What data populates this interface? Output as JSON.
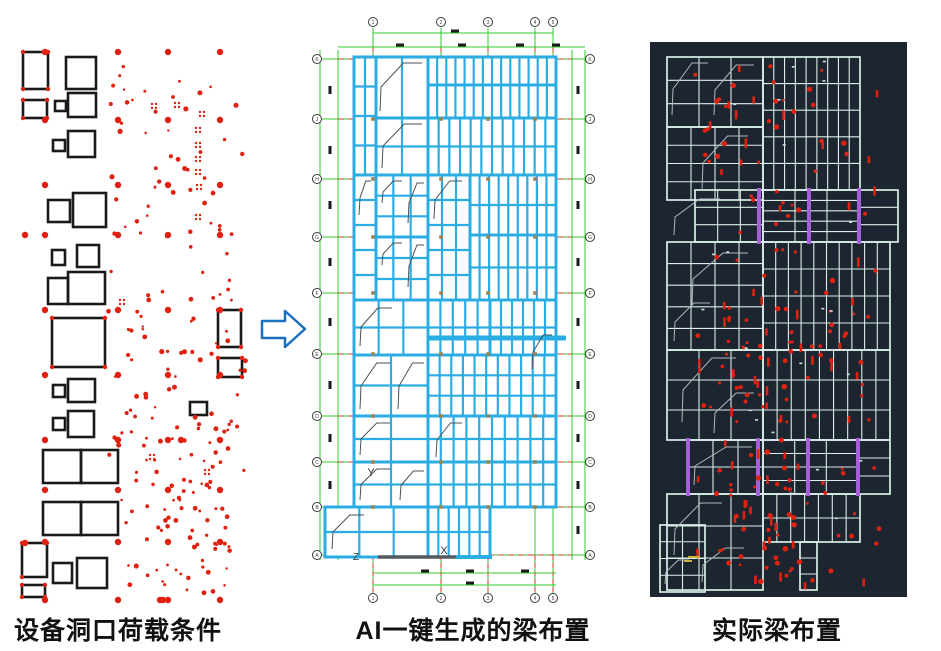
{
  "canvas": {
    "w": 941,
    "h": 651,
    "bg": "#ffffff"
  },
  "captions": {
    "left": "设备洞口荷载条件",
    "middle": "AI一键生成的梁布置",
    "right": "实际梁布置"
  },
  "colors": {
    "black": "#1a1a1a",
    "red": "#dd2212",
    "red_big": "#e02010",
    "cyan": "#2bade4",
    "green": "#2ecc2e",
    "grid_red": "#d03a2a",
    "olive": "#9b8450",
    "stair_gray": "#4a5156",
    "ucs_dark": "#2b3a42",
    "dark_bg": "#1d2630",
    "beam_light": "#d9efe8",
    "stair_light": "#aeb8bc",
    "purple": "#a55fd9",
    "yellow": "#c9b23e",
    "speck": "#cfe0e0",
    "arrow_blue": "#1d6fc0",
    "bubble": "#3a3a3a"
  },
  "arrow": {
    "points": "262,321 285,321 285,311 305,329 285,347 285,338 262,338"
  },
  "left_panel": {
    "rects": [
      [
        23,
        52,
        25,
        37
      ],
      [
        66,
        57,
        30,
        32
      ],
      [
        55,
        101,
        11,
        10
      ],
      [
        23,
        100,
        24,
        18
      ],
      [
        68,
        93,
        28,
        24
      ],
      [
        53,
        140,
        12,
        11
      ],
      [
        68,
        131,
        27,
        26
      ],
      [
        48,
        200,
        22,
        22
      ],
      [
        73,
        193,
        33,
        34
      ],
      [
        52,
        250,
        13,
        15
      ],
      [
        77,
        245,
        22,
        22
      ],
      [
        48,
        278,
        20,
        26
      ],
      [
        68,
        272,
        37,
        32
      ],
      [
        52,
        318,
        53,
        49
      ],
      [
        218,
        310,
        23,
        37
      ],
      [
        218,
        358,
        24,
        19
      ],
      [
        53,
        385,
        12,
        12
      ],
      [
        68,
        379,
        27,
        23
      ],
      [
        53,
        418,
        12,
        12
      ],
      [
        68,
        411,
        26,
        26
      ],
      [
        190,
        402,
        17,
        13
      ],
      [
        43,
        450,
        38,
        33
      ],
      [
        81,
        450,
        37,
        33
      ],
      [
        43,
        502,
        38,
        33
      ],
      [
        81,
        502,
        37,
        33
      ],
      [
        22,
        543,
        25,
        34
      ],
      [
        53,
        563,
        19,
        20
      ],
      [
        77,
        558,
        30,
        30
      ],
      [
        22,
        585,
        23,
        12
      ]
    ],
    "big_dot_cols": [
      45,
      118,
      168,
      220
    ],
    "big_dot_rows": [
      52,
      120,
      185,
      235,
      310,
      375,
      440,
      490,
      542,
      600
    ],
    "extra_big_dots": [
      [
        25,
        235
      ],
      [
        25,
        543
      ],
      [
        160,
        600
      ],
      [
        163,
        600
      ],
      [
        181,
        440
      ]
    ],
    "corner_dots": [
      [
        23,
        52
      ],
      [
        48,
        52
      ],
      [
        23,
        89
      ],
      [
        48,
        89
      ],
      [
        23,
        100
      ],
      [
        47,
        100
      ],
      [
        23,
        118
      ],
      [
        47,
        118
      ],
      [
        218,
        310
      ],
      [
        241,
        310
      ],
      [
        218,
        347
      ],
      [
        241,
        347
      ],
      [
        218,
        358
      ],
      [
        242,
        358
      ],
      [
        218,
        377
      ],
      [
        242,
        377
      ],
      [
        22,
        543
      ],
      [
        47,
        543
      ],
      [
        22,
        577
      ],
      [
        22,
        585
      ],
      [
        45,
        585
      ],
      [
        22,
        597
      ],
      [
        45,
        597
      ],
      [
        52,
        318
      ],
      [
        105,
        318
      ],
      [
        52,
        367
      ],
      [
        105,
        367
      ]
    ],
    "pair_clusters": [
      [
        196,
        128
      ],
      [
        196,
        143
      ],
      [
        196,
        157
      ],
      [
        196,
        170
      ],
      [
        197,
        185
      ],
      [
        200,
        112
      ],
      [
        152,
        104
      ],
      [
        175,
        103
      ],
      [
        120,
        300
      ],
      [
        196,
        215
      ],
      [
        150,
        455
      ],
      [
        205,
        470
      ]
    ],
    "scatter": {
      "seed": 42,
      "count": 155,
      "x0": 108,
      "x1": 246,
      "y0": 58,
      "y1": 596,
      "rmin": 1.2,
      "rmax": 2.6
    },
    "scatter2": {
      "seed": 9,
      "count": 45,
      "x0": 138,
      "x1": 232,
      "y0": 428,
      "y1": 595,
      "rmin": 1.2,
      "rmax": 2.4
    }
  },
  "middle_panel": {
    "outer_green_v": [
      [
        320,
        50,
        560
      ],
      [
        338,
        50,
        560
      ],
      [
        572,
        50,
        560
      ],
      [
        585,
        50,
        560
      ]
    ],
    "col_xs": [
      373,
      441,
      488,
      535,
      553
    ],
    "col_labels": [
      "1",
      "2",
      "3",
      "4",
      "5"
    ],
    "col_span_y": [
      28,
      596
    ],
    "row_ys": [
      59,
      119,
      179,
      237,
      293,
      354,
      416,
      462,
      507,
      555
    ],
    "row_labels": [
      "K",
      "J",
      "H",
      "G",
      "F",
      "E",
      "D",
      "C",
      "B",
      "A"
    ],
    "row_span_x": [
      312,
      594
    ],
    "red_dash_x": [
      338,
      572
    ],
    "dim_lines": [
      [
        373,
        33,
        553,
        33
      ],
      [
        338,
        47,
        585,
        47
      ],
      [
        373,
        573,
        556,
        573
      ],
      [
        373,
        585,
        556,
        585
      ]
    ],
    "dim_blobs_h": [
      [
        455,
        31
      ],
      [
        400,
        45
      ],
      [
        462,
        45
      ],
      [
        520,
        45
      ],
      [
        556,
        45
      ],
      [
        425,
        571
      ],
      [
        470,
        571
      ],
      [
        525,
        571
      ],
      [
        470,
        583
      ]
    ],
    "dim_blob_ys": [
      90,
      150,
      205,
      262,
      322,
      385,
      438,
      485,
      530
    ],
    "dim_blob_cols": [
      330,
      578
    ],
    "bubble_r": 4.5,
    "top_bubble_y": 22,
    "bottom_bubble_y": 598,
    "left_bubble_x": 317,
    "right_bubble_x": 590,
    "blocks": [
      [
        354,
        57,
        22,
        118,
        1,
        3
      ],
      [
        376,
        57,
        52,
        61,
        1,
        0
      ],
      [
        376,
        118,
        52,
        57,
        1,
        1
      ],
      [
        428,
        57,
        128,
        28,
        13,
        0
      ],
      [
        428,
        85,
        128,
        33,
        13,
        0
      ],
      [
        428,
        118,
        128,
        57,
        11,
        1
      ],
      [
        376,
        175,
        52,
        62,
        2,
        2
      ],
      [
        376,
        237,
        52,
        63,
        2,
        2
      ],
      [
        354,
        175,
        22,
        125,
        0,
        4
      ],
      [
        428,
        175,
        42,
        125,
        2,
        4
      ],
      [
        470,
        175,
        86,
        60,
        8,
        1
      ],
      [
        470,
        235,
        86,
        65,
        8,
        1
      ],
      [
        354,
        300,
        74,
        55,
        2,
        1
      ],
      [
        428,
        300,
        62,
        55,
        4,
        1
      ],
      [
        490,
        300,
        66,
        55,
        5,
        1
      ],
      [
        354,
        355,
        74,
        61,
        1,
        1
      ],
      [
        428,
        355,
        128,
        61,
        10,
        2
      ],
      [
        354,
        416,
        74,
        46,
        1,
        1
      ],
      [
        428,
        416,
        128,
        46,
        9,
        1
      ],
      [
        354,
        462,
        74,
        45,
        1,
        1
      ],
      [
        428,
        462,
        128,
        45,
        9,
        1
      ],
      [
        325,
        507,
        103,
        50,
        2,
        1
      ],
      [
        428,
        507,
        62,
        50,
        5,
        1
      ]
    ],
    "thick_lines": [
      [
        428,
        338,
        566,
        338,
        5
      ],
      [
        556,
        300,
        556,
        355,
        3
      ]
    ],
    "stairs": [
      [
        378,
        60,
        46,
        54
      ],
      [
        380,
        121,
        44,
        50
      ],
      [
        357,
        178,
        16,
        40
      ],
      [
        380,
        178,
        24,
        28
      ],
      [
        406,
        180,
        20,
        46
      ],
      [
        380,
        240,
        24,
        28
      ],
      [
        406,
        242,
        20,
        48
      ],
      [
        358,
        305,
        36,
        44
      ],
      [
        358,
        360,
        34,
        52
      ],
      [
        396,
        360,
        30,
        52
      ],
      [
        432,
        178,
        32,
        44
      ],
      [
        358,
        420,
        34,
        38
      ],
      [
        434,
        420,
        30,
        40
      ],
      [
        358,
        466,
        34,
        37
      ],
      [
        398,
        468,
        28,
        35
      ],
      [
        330,
        512,
        36,
        40
      ],
      [
        530,
        332,
        24,
        40
      ]
    ],
    "olive_cols": [
      373,
      441,
      488,
      535
    ],
    "olive_rows": [
      119,
      179,
      237,
      293,
      354,
      416,
      462,
      507
    ],
    "ucs": {
      "y_label": "Y",
      "x_label": "X",
      "z_label": "Z",
      "y_pos": [
        371,
        476
      ],
      "x_pos": [
        444,
        554
      ],
      "z_pos": [
        356,
        560
      ],
      "dark_line": [
        378,
        557,
        456,
        557
      ],
      "cyan_line": [
        456,
        557,
        492,
        557
      ]
    }
  },
  "right_panel": {
    "bg_rect": [
      650,
      42,
      257,
      555
    ],
    "blocks": [
      [
        667,
        57,
        96,
        70,
        2,
        2
      ],
      [
        667,
        127,
        96,
        73,
        3,
        3
      ],
      [
        763,
        57,
        97,
        133,
        8,
        4
      ],
      [
        695,
        190,
        68,
        52,
        2,
        2
      ],
      [
        763,
        190,
        96,
        52,
        2,
        4
      ],
      [
        859,
        190,
        39,
        52,
        0,
        2
      ],
      [
        667,
        242,
        96,
        108,
        3,
        4
      ],
      [
        763,
        242,
        127,
        108,
        9,
        3
      ],
      [
        667,
        350,
        96,
        90,
        2,
        2
      ],
      [
        763,
        350,
        127,
        90,
        8,
        2
      ],
      [
        688,
        440,
        75,
        54,
        2,
        1
      ],
      [
        763,
        440,
        95,
        54,
        2,
        3
      ],
      [
        858,
        440,
        32,
        54,
        0,
        2
      ],
      [
        667,
        494,
        96,
        96,
        2,
        2
      ],
      [
        763,
        494,
        97,
        48,
        6,
        1
      ],
      [
        800,
        542,
        17,
        48,
        0,
        2
      ],
      [
        660,
        525,
        45,
        67,
        1,
        3
      ]
    ],
    "stairs": [
      [
        670,
        60,
        40,
        58
      ],
      [
        712,
        62,
        44,
        56
      ],
      [
        700,
        133,
        50,
        60
      ],
      [
        672,
        196,
        50,
        42
      ],
      [
        690,
        250,
        60,
        58
      ],
      [
        672,
        300,
        40,
        44
      ],
      [
        680,
        355,
        58,
        70
      ],
      [
        712,
        390,
        44,
        46
      ],
      [
        692,
        444,
        62,
        44
      ],
      [
        672,
        500,
        52,
        58
      ],
      [
        700,
        545,
        46,
        40
      ],
      [
        663,
        557,
        28,
        30
      ]
    ],
    "purple_segments": [
      [
        759,
        188,
        759,
        244
      ],
      [
        809,
        188,
        809,
        244
      ],
      [
        859,
        188,
        859,
        244
      ],
      [
        688,
        438,
        688,
        496
      ],
      [
        758,
        438,
        758,
        496
      ],
      [
        808,
        438,
        808,
        496
      ],
      [
        858,
        438,
        858,
        496
      ]
    ],
    "red_scatter": {
      "seed": 77,
      "count": 150,
      "x0": 695,
      "x1": 880,
      "y0": 60,
      "y1": 585
    },
    "red_scatter2": {
      "seed": 13,
      "count": 60,
      "x0": 720,
      "x1": 800,
      "y0": 300,
      "y1": 585
    },
    "white_specks": {
      "seed": 3,
      "count": 22,
      "x0": 700,
      "x1": 870,
      "y0": 60,
      "y1": 580
    },
    "yellow_dashes": [
      [
        688,
        557,
        700,
        557
      ],
      [
        684,
        561,
        692,
        561
      ]
    ]
  }
}
